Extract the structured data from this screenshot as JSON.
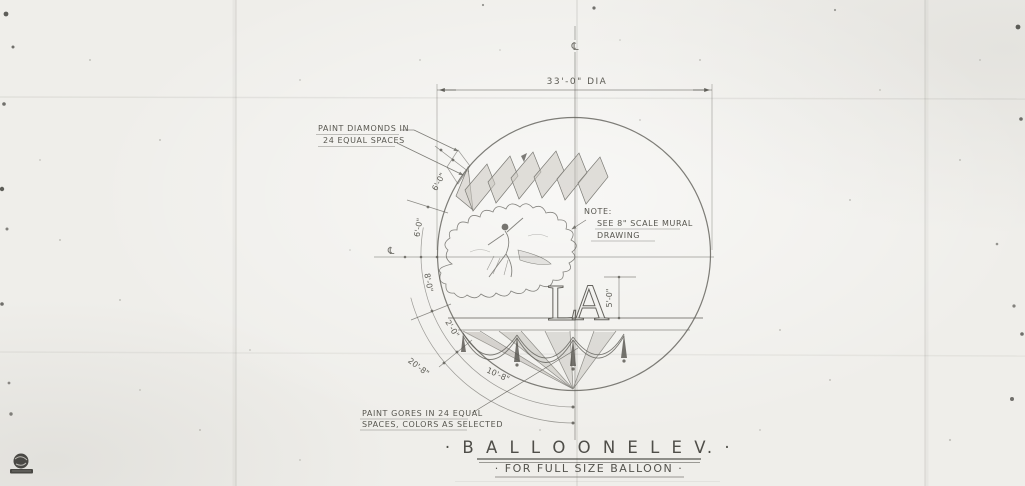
{
  "title_block": {
    "title": "· B A L L O O N   E L E V. ·",
    "subtitle": "· FOR  FULL  SIZE  BALLOON ·"
  },
  "annotations": {
    "paint_diamonds_line1": "PAINT DIAMONDS IN",
    "paint_diamonds_line2": "24 EQUAL SPACES",
    "note_heading": "NOTE:",
    "note_line1": "SEE 8\" SCALE MURAL",
    "note_line2": "DRAWING",
    "paint_gores_line1": "PAINT GORES IN 24 EQUAL",
    "paint_gores_line2": "SPACES, COLORS AS SELECTED"
  },
  "dimensions": {
    "diameter": "33'-0\" DIA",
    "diamond_band_height": "6'-0\"",
    "upper_arc": "6'-0\"",
    "lower_arc": "8'-0\"",
    "band_height": "2'-0\"",
    "gore_arc_outer": "20'-8\"",
    "gore_arc_inner": "10'-8\"",
    "monogram_height": "5'-0\""
  },
  "monogram": {
    "text": "LA"
  },
  "symbols": {
    "centerline_top": "℄",
    "centerline_left": "℄"
  },
  "colors": {
    "paper": "#efeeea",
    "pencil": "#5f5e58",
    "shade": "#b9b6ae"
  }
}
